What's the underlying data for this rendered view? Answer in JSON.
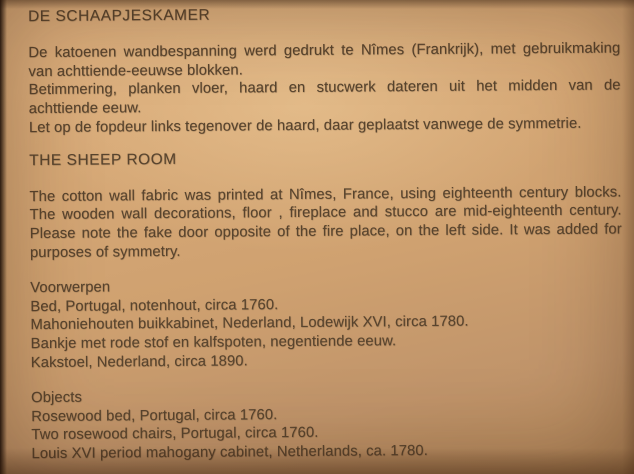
{
  "photo": {
    "paper_color": "#cfa170",
    "text_color": "#58442e"
  },
  "document": {
    "dutch": {
      "title": "DE SCHAAPJESKAMER",
      "para1_line1": "De katoenen wandbespanning werd gedrukt te Nîmes (Frankrijk), met gebruikmaking",
      "para1_line2": "van achttiende-eeuwse blokken.",
      "para2_line1": "Betimmering, planken vloer, haard en stucwerk dateren uit het midden van de",
      "para2_line2": "achttiende eeuw.",
      "note": "Let op de fopdeur links tegenover de haard, daar geplaatst vanwege de symmetrie."
    },
    "english": {
      "title": "THE SHEEP ROOM",
      "para_line1": "The cotton wall fabric was printed at Nîmes, France, using eighteenth century blocks.",
      "para_line2": "The wooden wall decorations, floor , fireplace and stucco are mid-eighteenth century.",
      "para_line3": "Please note the fake door opposite of the fire place, on the left side. It was added for",
      "para_line4": "purposes of symmetry."
    },
    "objects_nl": {
      "heading": "Voorwerpen",
      "items": [
        "Bed, Portugal, notenhout, circa 1760.",
        "Mahoniehouten buikkabinet, Nederland, Lodewijk XVI, circa 1780.",
        "Bankje met rode stof en kalfspoten, negentiende eeuw.",
        "Kakstoel, Nederland, circa 1890."
      ]
    },
    "objects_en": {
      "heading": "Objects",
      "items": [
        "Rosewood bed, Portugal, circa 1760.",
        "Two rosewood chairs, Portugal, circa 1760.",
        "Louis XVI period mahogany cabinet, Netherlands, ca. 1780."
      ]
    }
  }
}
